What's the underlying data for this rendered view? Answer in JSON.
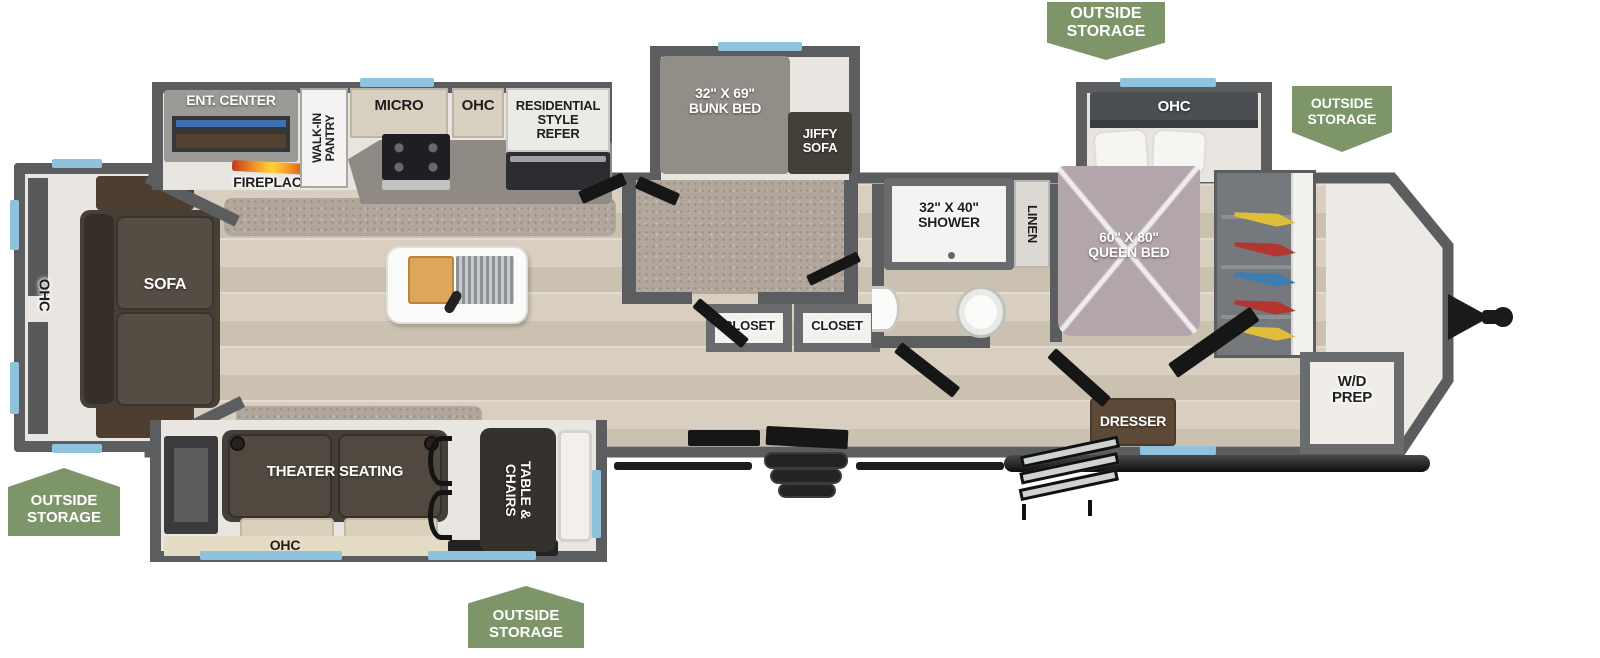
{
  "badges": {
    "text": "OUTSIDE\nSTORAGE"
  },
  "rooms": {
    "ent_center": "ENT. CENTER",
    "fireplace": "FIREPLACE",
    "walk_in_pantry": "WALK-IN\nPANTRY",
    "micro": "MICRO",
    "ohc": "OHC",
    "refer": "RESIDENTIAL\nSTYLE\nREFER",
    "bunk_bed": "32\" X 69\"\nBUNK BED",
    "jiffy_sofa": "JIFFY\nSOFA",
    "shower": "32\" X 40\"\nSHOWER",
    "linen": "LINEN",
    "queen_bed": "60\" X 80\"\nQUEEN BED",
    "sofa": "SOFA",
    "closet": "CLOSET",
    "dresser": "DRESSER",
    "wd_prep": "W/D\nPREP",
    "theater_seating": "THEATER SEATING",
    "table_chairs": "TABLE &\nCHAIRS"
  },
  "colors": {
    "badge_green": "#7d9568",
    "window_blue": "#8ec2dd",
    "wall_gray": "#5c5d5f",
    "floor_wood": "#d5ccbd",
    "carpet": "#b1a79d",
    "bed_mauve": "#b2a6ac",
    "sofa_brown": "#463f38",
    "flame_orange": "#f59a23"
  }
}
